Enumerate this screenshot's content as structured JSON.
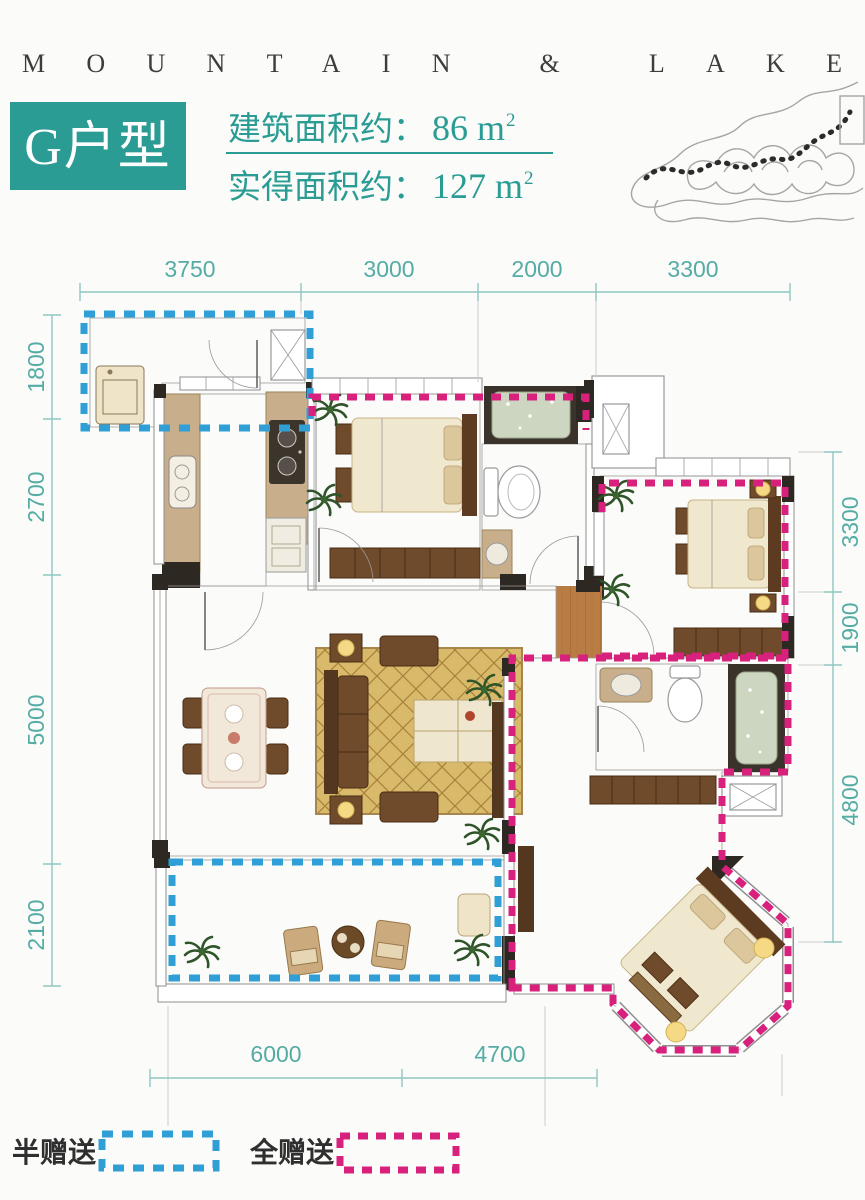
{
  "brand": {
    "title": "MOUNTAIN & LAKE"
  },
  "header": {
    "unit": "G户型",
    "rows": [
      {
        "label": "建筑面积约：",
        "value": "86 m",
        "sup": "2"
      },
      {
        "label": "实得面积约：",
        "value": "127 m",
        "sup": "2"
      }
    ]
  },
  "dimensions": {
    "top": [
      "3750",
      "3000",
      "2000",
      "3300"
    ],
    "left": [
      "1800",
      "2700",
      "5000",
      "2100"
    ],
    "right": [
      "3300",
      "1900",
      "4800"
    ],
    "bottom": [
      "6000",
      "4700"
    ]
  },
  "legend": [
    {
      "label": "半赠送",
      "style": "blue-dashed"
    },
    {
      "label": "全赠送",
      "style": "magenta-dashed"
    }
  ],
  "colors": {
    "accent": "#2a9c94",
    "dim_line": "#8fc7c1",
    "dim_text": "#54aca4",
    "dash_blue": "#2f9fd6",
    "dash_magenta": "#d8217d",
    "terracotta": "#b5714e",
    "wood": "#b87c44",
    "cream": "#ecdfb4",
    "tile": "#a9ac9e",
    "counter": "#c8ae8b",
    "wall": "#2e2822",
    "furniture": "#6f4a2b",
    "furniture_dark": "#53371e",
    "bedding": "#f0e7cf",
    "pillow": "#dcc79d",
    "rug": "#d9b96a",
    "glow": "#f5d985",
    "sketch": "#a5a5a5"
  }
}
